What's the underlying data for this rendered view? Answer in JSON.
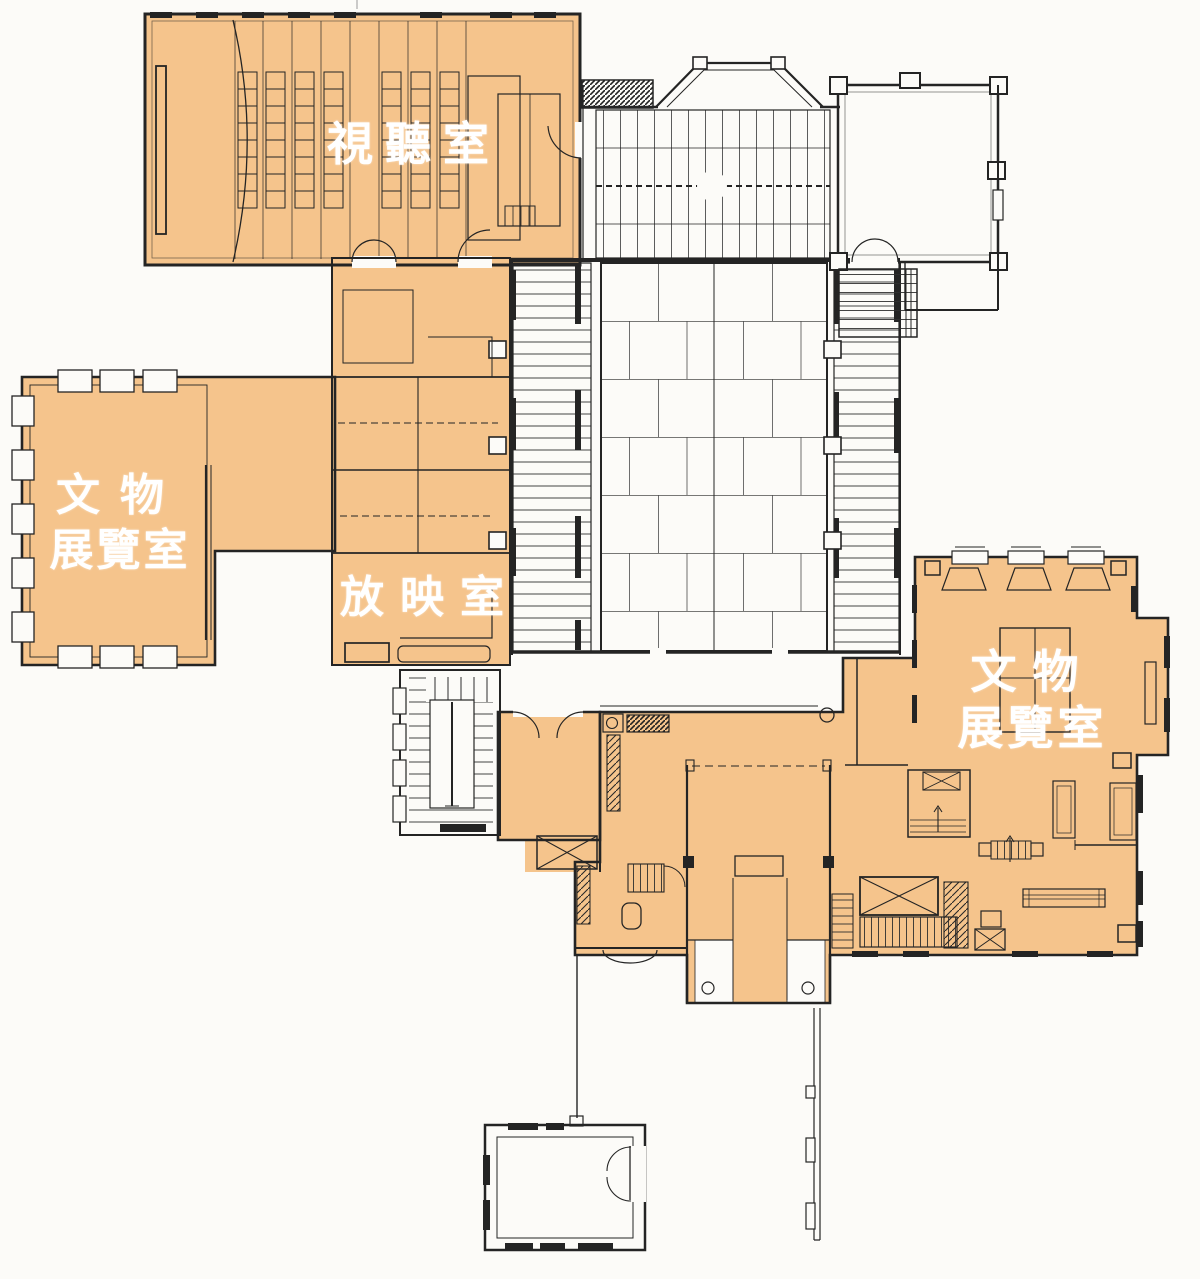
{
  "colors": {
    "highlight": "#F5C48C",
    "line": "#242424",
    "paper": "#FCFBF8",
    "label_text": "#FFFFFF"
  },
  "rooms": [
    {
      "id": "audio-visual-room",
      "label": "視聽室",
      "highlighted": true
    },
    {
      "id": "artifact-exhibition-room-west",
      "label_line1": "文物",
      "label_line2": "展覽室",
      "highlighted": true
    },
    {
      "id": "projection-room",
      "label": "放映室",
      "highlighted": true
    },
    {
      "id": "artifact-exhibition-room-east",
      "label_line1": "文物",
      "label_line2": "展覽室",
      "highlighted": true
    }
  ]
}
